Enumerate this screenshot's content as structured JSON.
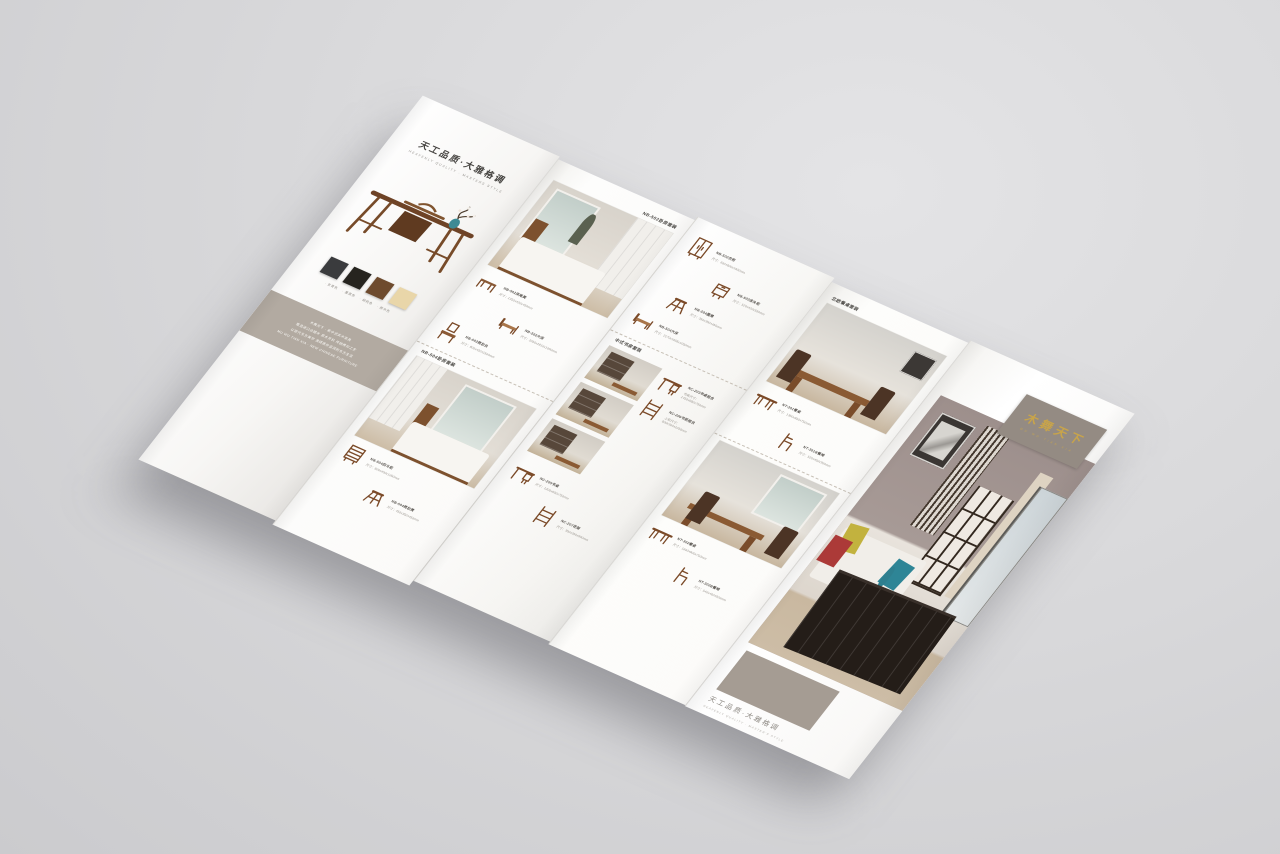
{
  "scene": {
    "background": "#d9d9db",
    "colors": {
      "accent_gold": "#c8a44a",
      "intro_band_taupe": "#b2aaa1",
      "logo_taupe": "#948b83",
      "cover_taupe": "#a59c93",
      "wood": "#7b4a28"
    }
  },
  "panelA": {
    "title": "天工品质·大雅格调",
    "subtitle": "HEAVENLY QUALITY · MASTERS STYLE",
    "swatches": [
      {
        "label": "玄青色",
        "color": "#3a3b3d"
      },
      {
        "label": "墨黑色",
        "color": "#26241f"
      },
      {
        "label": "胡桃色",
        "color": "#6e4b2e"
      },
      {
        "label": "原木色",
        "color": "#e9d6a9"
      }
    ],
    "intro": [
      "木舞天下 · 新中式实木家具",
      "甄选进口白蜡木 原木开料 传统榫卯工艺",
      "以现代东方美学 演绎质朴温润的东方生活",
      "MU WU TIAN XIA · NEW CHINESE FURNITURE"
    ]
  },
  "panelB": {
    "header": "NB-502卧房套装",
    "items": [
      {
        "glyph": "#g-bench",
        "name": "NB-502床尾凳",
        "size": "尺寸：1350x420x450mm"
      },
      {
        "glyph": "#g-bed",
        "name": "NB-502大床",
        "size": "尺寸：2050x1810x1060mm"
      },
      {
        "glyph": "#g-dresser",
        "name": "NB-502梳妆台",
        "size": "尺寸：800x420x1500mm"
      }
    ],
    "header2": "NB-504卧房套装",
    "items2": [
      {
        "glyph": "#g-chest",
        "name": "NB-504四斗柜",
        "size": "尺寸：800x450x1050mm"
      },
      {
        "glyph": "#g-stool",
        "name": "NB-504梳妆凳",
        "size": "尺寸：450x350x450mm"
      }
    ]
  },
  "panelC": {
    "items": [
      {
        "glyph": "#g-wardrobe",
        "name": "NB-502衣柜",
        "size": "尺寸：600x600x1900mm"
      },
      {
        "glyph": "#g-cabinet",
        "name": "NB-502床头柜",
        "size": "尺寸：520x420x550mm"
      },
      {
        "glyph": "#g-stool",
        "name": "NB-504圆凳",
        "size": "尺寸：350x350x450mm"
      },
      {
        "glyph": "#g-bed",
        "name": "NB-504大床",
        "size": "尺寸：2170x1655x1050mm"
      }
    ],
    "study_header": "中式书房套装",
    "study_items": [
      {
        "glyph": "#g-desk",
        "name": "NC-203书桌组合",
        "size": "书桌尺寸：1450x680x750mm"
      },
      {
        "glyph": "#g-shelf",
        "name": "NC-206书柜组合",
        "size": "上柜尺寸：800x300x1050mm"
      },
      {
        "glyph": "#g-desk",
        "name": "NC-205书桌",
        "size": "尺寸：1200x600x750mm"
      },
      {
        "glyph": "#g-shelf",
        "name": "NC-207花架",
        "size": "尺寸：350x350x900mm"
      }
    ]
  },
  "panelD": {
    "header": "北欧餐桌套装",
    "items": [
      {
        "glyph": "#g-table",
        "name": "NT-301餐桌",
        "size": "尺寸：1350x850x750mm"
      },
      {
        "glyph": "#g-chair",
        "name": "NT-301B餐椅",
        "size": "尺寸：520x450x900mm"
      }
    ],
    "items2": [
      {
        "glyph": "#g-table",
        "name": "NT-302餐桌",
        "size": "尺寸：1600x900x750mm"
      },
      {
        "glyph": "#g-chair",
        "name": "NT-302B餐椅",
        "size": "尺寸：540x460x920mm"
      }
    ]
  },
  "panelE": {
    "logo": "木舞天下",
    "logo_pinyin": "MU WU TIAN XIA",
    "caption_title": "天工品质·大雅格调",
    "caption_subtitle": "HEAVENLY QUALITY · MASTER'S STYLE"
  }
}
